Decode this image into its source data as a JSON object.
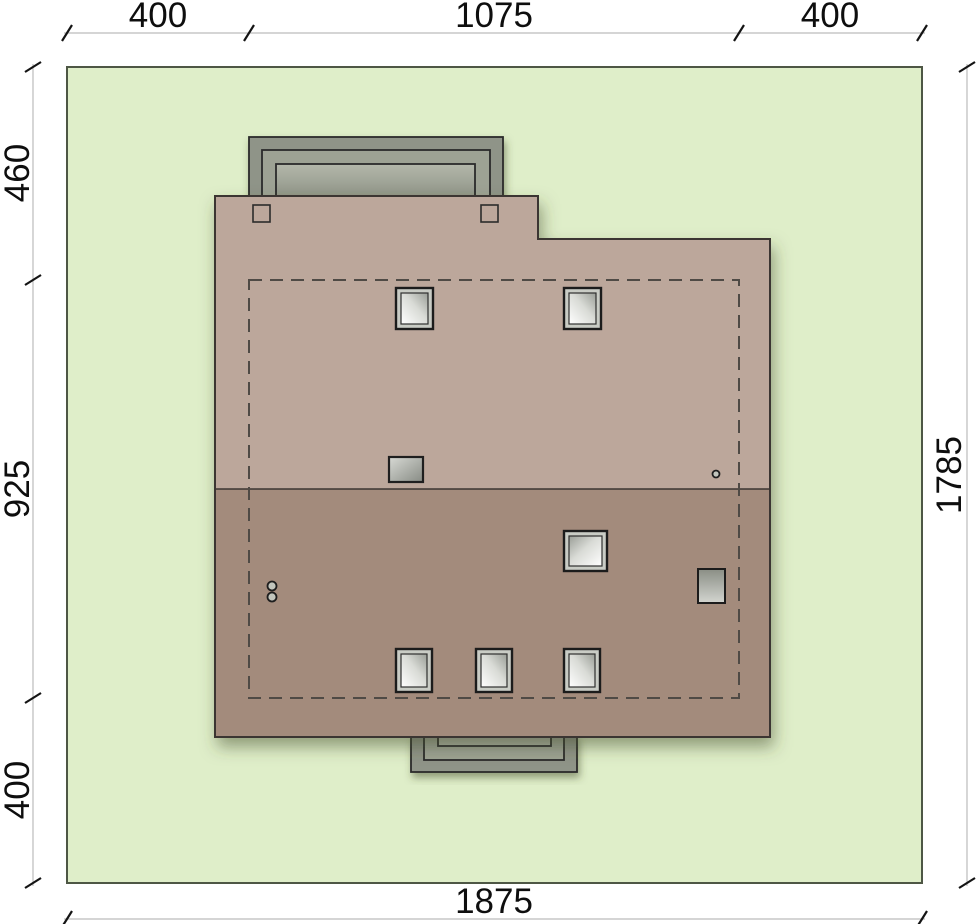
{
  "dimensions": {
    "top": {
      "segments": [
        "400",
        "1075",
        "400"
      ]
    },
    "left": {
      "segments": [
        "460",
        "925",
        "400"
      ]
    },
    "right": {
      "total": "1785"
    },
    "bottom": {
      "total": "1875"
    }
  },
  "colors": {
    "plot_green": "#dfeec9",
    "plot_border": "#4e5745",
    "roof_upper": "#bca79b",
    "roof_lower": "#a38b7c",
    "roof_outline": "#3a3632",
    "dashed_outline": "#4f4a45",
    "terrace_outer": "#8f9488",
    "terrace_mid": "#9da294",
    "terrace_inner": "#abb0a2",
    "dim_line": "#bcbcbc",
    "dim_text": "#0e0e0e",
    "shadow": "#3f4a25"
  }
}
